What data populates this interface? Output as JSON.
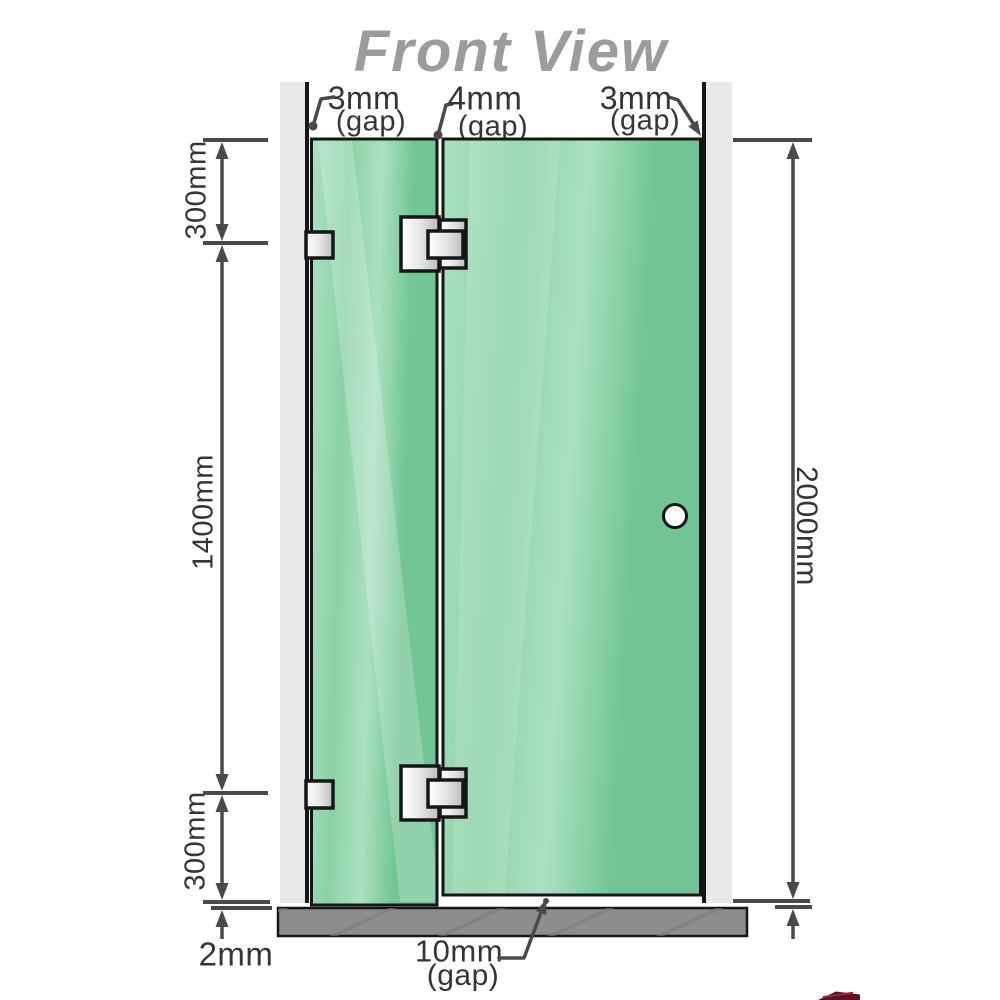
{
  "title": "Front View",
  "dims": [
    {
      "id": "top-hinge-offset",
      "value": "300mm"
    },
    {
      "id": "hinge-spacing",
      "value": "1400mm"
    },
    {
      "id": "bottom-hinge-offset",
      "value": "300mm"
    },
    {
      "id": "floor-clearance",
      "value": "2mm"
    },
    {
      "id": "opening-height",
      "value": "2000mm"
    }
  ],
  "gaps": [
    {
      "id": "wall-left-gap",
      "value": "3mm",
      "suffix": "(gap)"
    },
    {
      "id": "panel-joint-gap",
      "value": "4mm",
      "suffix": "(gap)"
    },
    {
      "id": "wall-right-gap",
      "value": "3mm",
      "suffix": "(gap)"
    },
    {
      "id": "floor-gap",
      "value": "10mm",
      "suffix": "(gap)"
    }
  ],
  "colors": {
    "glass": "#8bd2a7",
    "glass-light": "#aae1c0",
    "glass-dark": "#72c695",
    "wall": "#e9e9e9",
    "floor": "#8d8d8d",
    "floor-hatch": "#7c7c7c",
    "outline": "#161616",
    "line": "#4a4a4a",
    "label": "#353535",
    "title": "#9c9c9c",
    "metal-light": "#ffffff",
    "metal-dark": "#bdbdbd",
    "watermark": "#5e1120"
  }
}
